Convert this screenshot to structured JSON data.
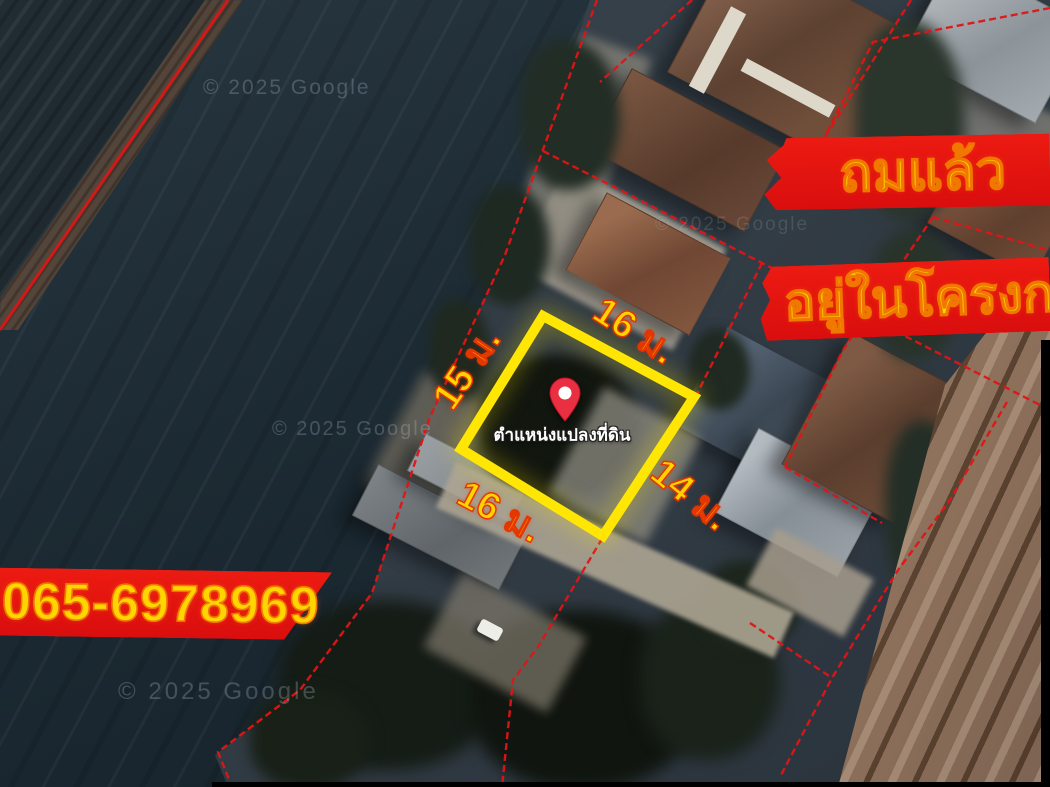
{
  "map": {
    "attribution": "© 2025 Google"
  },
  "plot": {
    "marker_label": "ตำแหน่งแปลงที่ดิน",
    "dimensions": {
      "top": "16 ม.",
      "left": "15 ม.",
      "bottom": "16 ม.",
      "right": "14 ม."
    }
  },
  "banners": {
    "filled_status": "ถมแล้ว",
    "project_status": "อยู่ในโครงการ",
    "phone": "065-6978969"
  },
  "colors": {
    "banner_red": "#e21111",
    "text_yellow": "#ffd400",
    "plot_outline_yellow": "#ffe605",
    "boundary_line_red": "#e01515",
    "pin_red": "#e93042"
  }
}
